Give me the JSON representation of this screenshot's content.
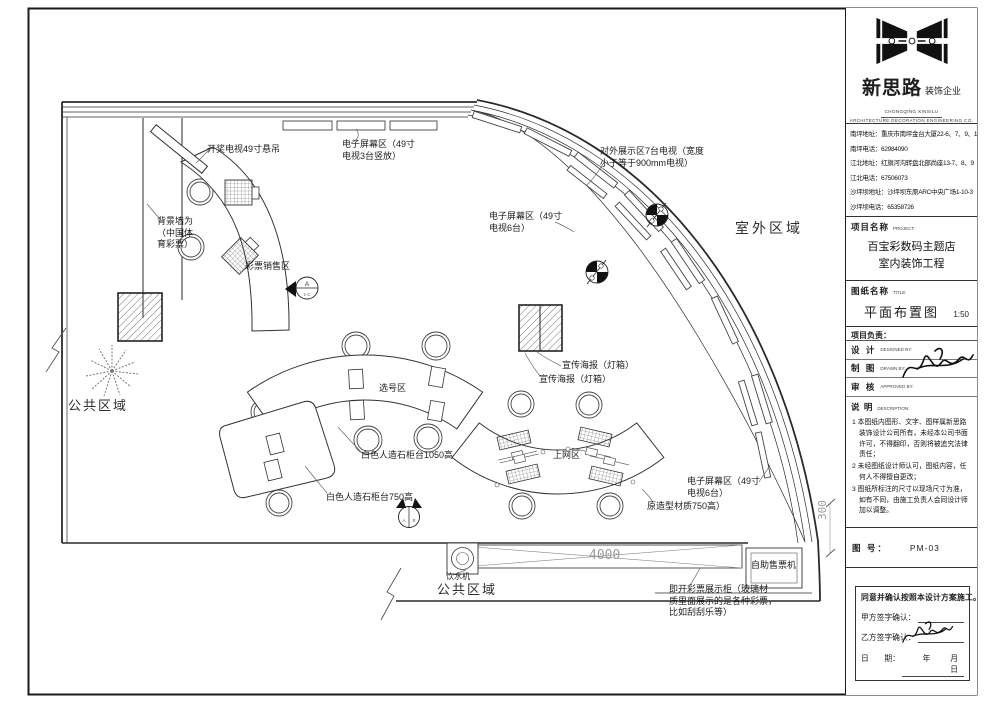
{
  "title_block": {
    "logo": {
      "company_cn": "新思路",
      "company_suffix": "装饰企业",
      "company_en_1": "CHONGQING XINSILU",
      "company_en_2": "ARCHITECTURE DECORATION ENGINEERING CO. LTD"
    },
    "contacts": [
      "南坪地址：重庆市南坪金台大厦22-6、7、9、10",
      "南坪电话：62984090",
      "江北地址：红旗河沟转盘北部尚座13-7、8、9",
      "江北电话：67506073",
      "沙坪坝地址：沙坪坝东原ARC中央广场1-10-3",
      "沙坪坝电话：65358726"
    ],
    "project": {
      "label": "项目名称",
      "label_en": "PROJECT:",
      "name_line1": "百宝彩数码主题店",
      "name_line2": "室内装饰工程"
    },
    "drawing": {
      "label": "图纸名称",
      "label_en": "TITLE:",
      "name": "平面布置图",
      "scale": "1:50"
    },
    "leader_label": "项目负责：",
    "roles": [
      {
        "cn": "设 计",
        "en": "DESIGNED BY:"
      },
      {
        "cn": "制 图",
        "en": "DRAWN BY:"
      },
      {
        "cn": "审 核",
        "en": "APPROVED BY:"
      }
    ],
    "description": {
      "label": "说 明",
      "label_en": "DESCRIPTION:",
      "notes": [
        "1 本图纸内图形、文字、图样属新思路装饰设计公司所有，未经本公司书面许可，不得翻印，否则将被追究法律责任；",
        "2 未经图纸设计师认可，图纸内容，任何人不得擅自更改；",
        "3 图纸所标注的尺寸以现场尺寸为准，如有不同，由施工负责人会同设计师加以调整。"
      ]
    },
    "sheet": {
      "label": "图 号：",
      "number": "PM-03"
    },
    "confirm": {
      "statement": "同意并确认按照本设计方案施工。",
      "party_a": "甲方签字确认：",
      "party_b": "乙方签字确认：",
      "date_label": "日　　期：",
      "date_units": "年　月　日"
    }
  },
  "plan": {
    "drawing_colors": {
      "line": "#2a2a2a",
      "dim": "#9a9a9a",
      "hatch": "#666666"
    },
    "annotations": [
      {
        "name": "label-lottery-tv",
        "text": "开奖电视49寸悬吊",
        "x": 207,
        "y": 144
      },
      {
        "name": "label-screen-zone-top",
        "text": "电子屏幕区（49寸\n电视3台竖放）",
        "x": 342,
        "y": 139
      },
      {
        "name": "label-outward-display",
        "text": "对外展示区7台电视（宽度\n小于等于900mm电视）",
        "x": 600,
        "y": 146
      },
      {
        "name": "label-screen-zone-upper-right",
        "text": "电子屏幕区（49寸\n电视6台）",
        "x": 489,
        "y": 211
      },
      {
        "name": "label-outdoor-area",
        "text": "室外区域",
        "x": 735,
        "y": 221,
        "cls": "area"
      },
      {
        "name": "label-background-wall",
        "text": "背景墙为\n（中国体\n育彩票）",
        "x": 157,
        "y": 216
      },
      {
        "name": "label-ticket-sales-zone",
        "text": "彩票销售区",
        "x": 245,
        "y": 261
      },
      {
        "name": "label-public-area-left",
        "text": "公共区域",
        "x": 68,
        "y": 398,
        "cls": "area-sm"
      },
      {
        "name": "label-number-picking-zone",
        "text": "选号区",
        "x": 379,
        "y": 383
      },
      {
        "name": "label-poster-lightbox-1",
        "text": "宣传海报（灯箱）",
        "x": 562,
        "y": 360
      },
      {
        "name": "label-poster-lightbox-2",
        "text": "宣传海报（灯箱）",
        "x": 539,
        "y": 374
      },
      {
        "name": "label-counter-1050",
        "text": "白色人造石柜台1050高",
        "x": 361,
        "y": 450
      },
      {
        "name": "label-internet-zone",
        "text": "上网区",
        "x": 553,
        "y": 450
      },
      {
        "name": "label-counter-750",
        "text": "白色人造石柜台750高",
        "x": 326,
        "y": 492
      },
      {
        "name": "label-screen-zone-lower-right",
        "text": "电子屏幕区（49寸\n电视6台）",
        "x": 687,
        "y": 476
      },
      {
        "name": "label-material-750",
        "text": "原造型材质750高）",
        "x": 647,
        "y": 501
      },
      {
        "name": "label-ticket-vending-machine",
        "text": "自助售票机",
        "x": 751,
        "y": 560
      },
      {
        "name": "label-instant-ticket-cabinet",
        "text": "即开彩票展示柜（玻璃材\n质里面展示的是各种彩票，\n比如刮刮乐等）",
        "x": 669,
        "y": 584
      },
      {
        "name": "label-water-dispenser",
        "text": "饮水机",
        "x": 446,
        "y": 572,
        "size": 8
      },
      {
        "name": "label-public-area-bottom",
        "text": "公共区域",
        "x": 437,
        "y": 582,
        "cls": "area-sm"
      },
      {
        "name": "dim-4000",
        "text": "4000",
        "x": 589,
        "y": 548,
        "cls": "dim",
        "size": 13
      },
      {
        "name": "dim-300",
        "text": "300",
        "x": 816,
        "y": 520,
        "cls": "dim",
        "size": 11,
        "rot": -90
      }
    ]
  }
}
